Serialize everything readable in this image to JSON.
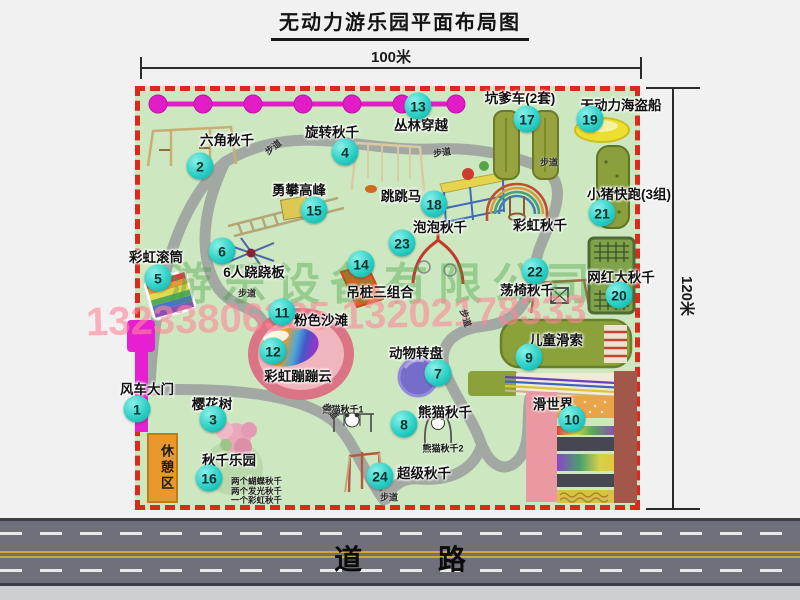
{
  "title": "无动力游乐园平面布局图",
  "dimensions": {
    "width_label": "100米",
    "height_label": "120米"
  },
  "road_label": "道 路",
  "rest_area_label": "休憩区",
  "watermarks": {
    "company": "游乐设备有限公司",
    "phone": "13233806335 13202178333"
  },
  "colors": {
    "park_green": "#cde8c1",
    "border_red": "#d92a1c",
    "badge_cyan": "#2bd0c6",
    "zipline_magenta": "#e21cc6",
    "road_gray": "#70707a",
    "rest_area_orange": "#e8982c",
    "path_gray": "#a2a8a2"
  },
  "attractions": [
    {
      "num": 1,
      "name": "风车大门",
      "label": {
        "x": 147,
        "y": 388
      },
      "badge": {
        "x": 137,
        "y": 409
      }
    },
    {
      "num": 2,
      "name": "六角秋千",
      "label": {
        "x": 227,
        "y": 139
      },
      "badge": {
        "x": 200,
        "y": 166
      }
    },
    {
      "num": 3,
      "name": "樱花树",
      "label": {
        "x": 212,
        "y": 403
      },
      "badge": {
        "x": 213,
        "y": 419
      }
    },
    {
      "num": 4,
      "name": "旋转秋千",
      "label": {
        "x": 332,
        "y": 131
      },
      "badge": {
        "x": 345,
        "y": 152
      }
    },
    {
      "num": 5,
      "name": "彩虹滚筒",
      "label": {
        "x": 156,
        "y": 256
      },
      "badge": {
        "x": 158,
        "y": 278
      }
    },
    {
      "num": 6,
      "name": "6人跷跷板",
      "label": {
        "x": 254,
        "y": 271
      },
      "badge": {
        "x": 222,
        "y": 251
      }
    },
    {
      "num": 7,
      "name": "动物转盘",
      "label": {
        "x": 416,
        "y": 352
      },
      "badge": {
        "x": 438,
        "y": 373
      }
    },
    {
      "num": 8,
      "name": "熊猫秋千",
      "label": {
        "x": 445,
        "y": 411
      },
      "badge": {
        "x": 404,
        "y": 424
      }
    },
    {
      "num": 9,
      "name": "儿童滑索",
      "label": {
        "x": 556,
        "y": 339
      },
      "badge": {
        "x": 529,
        "y": 357
      }
    },
    {
      "num": 10,
      "name": "滑世界",
      "label": {
        "x": 553,
        "y": 403
      },
      "badge": {
        "x": 572,
        "y": 419
      }
    },
    {
      "num": 11,
      "name": "粉色沙滩",
      "label": {
        "x": 321,
        "y": 319
      },
      "badge": {
        "x": 282,
        "y": 312
      }
    },
    {
      "num": 12,
      "name": "彩虹蹦蹦云",
      "label": {
        "x": 298,
        "y": 375
      },
      "badge": {
        "x": 273,
        "y": 351
      }
    },
    {
      "num": 13,
      "name": "丛林穿越",
      "label": {
        "x": 421,
        "y": 124
      },
      "badge": {
        "x": 418,
        "y": 106
      }
    },
    {
      "num": 14,
      "name": "吊桩三组合",
      "label": {
        "x": 380,
        "y": 291
      },
      "badge": {
        "x": 361,
        "y": 264
      }
    },
    {
      "num": 15,
      "name": "勇攀高峰",
      "label": {
        "x": 299,
        "y": 189
      },
      "badge": {
        "x": 314,
        "y": 210
      }
    },
    {
      "num": 16,
      "name": "秋千乐园",
      "label": {
        "x": 229,
        "y": 459
      },
      "badge": {
        "x": 209,
        "y": 478
      },
      "notes": [
        "两个蝴蝶秋千",
        "两个发光秋千",
        "一个彩虹秋千"
      ],
      "notes_pos": {
        "x": 231,
        "y": 477
      }
    },
    {
      "num": 17,
      "name": "坑爹车(2套)",
      "label": {
        "x": 520,
        "y": 97
      },
      "badge": {
        "x": 527,
        "y": 119
      }
    },
    {
      "num": 18,
      "name": "跳跳马",
      "label": {
        "x": 401,
        "y": 195
      },
      "badge": {
        "x": 434,
        "y": 204
      }
    },
    {
      "num": 19,
      "name": "无动力海盗船",
      "label": {
        "x": 621,
        "y": 104
      },
      "badge": {
        "x": 590,
        "y": 119
      }
    },
    {
      "num": 20,
      "name": "网红大秋千",
      "label": {
        "x": 621,
        "y": 276
      },
      "badge": {
        "x": 619,
        "y": 295
      }
    },
    {
      "num": 21,
      "name": "小猪快跑(3组)",
      "label": {
        "x": 629,
        "y": 193
      },
      "badge": {
        "x": 602,
        "y": 213
      }
    },
    {
      "num": 22,
      "name": "荡椅秋千",
      "label": {
        "x": 527,
        "y": 289
      },
      "badge": {
        "x": 535,
        "y": 271
      }
    },
    {
      "num": 23,
      "name": "泡泡秋千",
      "label": {
        "x": 440,
        "y": 226
      },
      "badge": {
        "x": 402,
        "y": 243
      }
    },
    {
      "num": 24,
      "name": "超级秋千",
      "label": {
        "x": 424,
        "y": 472
      },
      "badge": {
        "x": 380,
        "y": 476
      }
    },
    {
      "num": null,
      "name": "彩虹秋千",
      "label": {
        "x": 540,
        "y": 224
      }
    }
  ],
  "sub_labels": [
    {
      "text": "熊猫秋千1",
      "x": 343,
      "y": 409
    },
    {
      "text": "熊猫秋千2",
      "x": 443,
      "y": 448
    }
  ],
  "path_labels": [
    {
      "text": "步道",
      "x": 273,
      "y": 147,
      "rot": -38
    },
    {
      "text": "步道",
      "x": 442,
      "y": 152,
      "rot": -8
    },
    {
      "text": "步道",
      "x": 549,
      "y": 162,
      "rot": 0
    },
    {
      "text": "步道",
      "x": 247,
      "y": 293,
      "rot": 0
    },
    {
      "text": "步道",
      "x": 466,
      "y": 318,
      "rot": 72
    },
    {
      "text": "步道",
      "x": 331,
      "y": 411,
      "rot": 48
    },
    {
      "text": "步道",
      "x": 389,
      "y": 497,
      "rot": 0
    }
  ]
}
